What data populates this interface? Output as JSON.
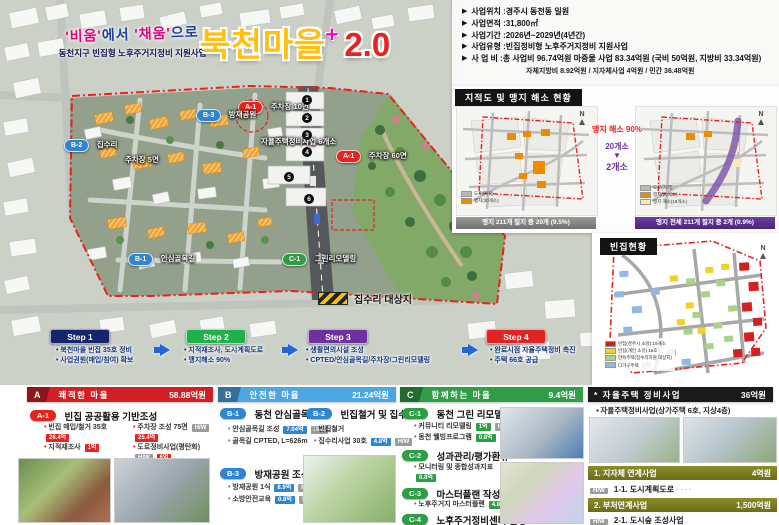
{
  "icons": {
    "info_bullet": "▶",
    "compass": "N"
  },
  "colors": {
    "section_a": "#d21f26",
    "section_b": "#4ba7e2",
    "section_c": "#2f9e46",
    "step1": "#16246e",
    "step2": "#21b14c",
    "step3": "#7030a0",
    "step4": "#e32222",
    "title_yellow": "#ffc10e",
    "title_red": "#e8221f",
    "mangji_orange": "#f08b00",
    "relief_purple": "#6b3fa0"
  },
  "title": {
    "slogan_q1": "'비움'",
    "slogan_m1": "에서 ",
    "slogan_q2": "'채움'",
    "slogan_m2": "으로",
    "subtitle": "동천지구 빈집형 노후주거지정비 지원사업",
    "main": "북천마을",
    "plus": "+",
    "version": "2.0"
  },
  "info": {
    "items": [
      {
        "label": "사업위치",
        "value": "경주시 동천동 일원"
      },
      {
        "label": "사업면적",
        "value": "31,800㎡"
      },
      {
        "label": "사업기간",
        "value": "2026년~2029년(4년간)"
      },
      {
        "label": "사업유형",
        "value": "빈집정비형 노후주거지정비 지원사업"
      },
      {
        "label": "사 업 비",
        "value": "총 사업비 96.74억원 마중물 사업 83.34억원 (국비 50억원, 지방비 33.34억원)"
      }
    ],
    "note": "자체지방비 8.92억원 / 지자체사업 4억원 / 민간 36.48억원"
  },
  "map": {
    "markers": {
      "a1_top": {
        "code": "A-1",
        "label": "주차장 10면"
      },
      "b3": {
        "code": "B-3",
        "label": "방재공원"
      },
      "b2": {
        "code": "B-2",
        "label": "집수리"
      },
      "parking5": "주차장 5면",
      "jayul": "자율주택정비사업 6개소",
      "a1_mid": {
        "code": "A-1",
        "label": "주차장 60면"
      },
      "b1": {
        "code": "B-1",
        "label": "안심골목길"
      },
      "c1": {
        "code": "C-1",
        "label": "그린리모델링"
      }
    },
    "numbers": [
      "1",
      "2",
      "3",
      "4",
      "5",
      "6"
    ],
    "legend": "집수리 대상지"
  },
  "cadastral": {
    "title": "지적도 및 맹지 해소 현황",
    "compass": "N",
    "center": {
      "headline": "맹지 해소 90%",
      "from": "20개소",
      "arrow": "▼",
      "to": "2개소"
    },
    "left_legend": [
      {
        "color": "#b9b9b9",
        "label": "도로(지적)"
      },
      {
        "color": "#f08b00",
        "label": "맹지(20개소)"
      }
    ],
    "right_legend": [
      {
        "color": "#b9b9b9",
        "label": "도로(지적)"
      },
      {
        "color": "#f08b00",
        "label": "맹지(20개소)"
      },
      {
        "color": "#f3ecc2",
        "label": "맹지 해소(18개소)"
      }
    ],
    "left_caption": "맹지 211개 필지 중 20개 (9.5%)",
    "right_caption": "맹지 전체 211개 필지 중 2개 (0.9%)"
  },
  "vacant": {
    "title": "빈집현황",
    "compass": "N",
    "legend": [
      {
        "color": "#cc2020",
        "label": "빈집(경주시 소유) 19개소"
      },
      {
        "color": "#f2d21f",
        "label": "빈집(개인 소유) 16호"
      },
      {
        "color": "#a9d487",
        "label": "단독주택(집수리지원 대상지)"
      },
      {
        "color": "#8fb9e4",
        "label": "다가구주택"
      }
    ]
  },
  "steps": [
    {
      "label": "Step 1",
      "bullets": [
        "북천마을 빈집 35호 정비",
        "사업권원(매입/참여) 확보"
      ]
    },
    {
      "label": "Step 2",
      "bullets": [
        "지적재조사, 도시계획도로",
        "맹지해소 90%"
      ]
    },
    {
      "label": "Step 3",
      "bullets": [
        "생활편의시설 조성",
        "CPTED/안심골목길/주차장/그린리모델링"
      ]
    },
    {
      "label": "Step 4",
      "bullets": [
        "완료시점 자율주택정비 촉진",
        "주택 66호 공급"
      ]
    }
  ],
  "sections": {
    "a": {
      "code": "A",
      "title": "쾌적한 마을",
      "amount": "58.88억원",
      "group": {
        "code": "A-1",
        "title": "빈집 공공활용 기반조성"
      },
      "col1": [
        {
          "text": "빈집 매입/철거 35호",
          "b1": "26.4억"
        },
        {
          "text": "지적재조사",
          "b1": "1억"
        }
      ],
      "col2": [
        {
          "text": "주차장 조성 75면",
          "hw": "H/W",
          "b1": "25.4억"
        },
        {
          "text": "도로정비사업(평탄화)",
          "hw": "H/W",
          "b1": "6억"
        }
      ]
    },
    "b": {
      "code": "B",
      "title": "안전한 마을",
      "amount": "21.24억원",
      "groups": [
        {
          "code": "B-1",
          "title": "동천 안심골목길",
          "bullets": [
            {
              "text": "안심골목길 조성",
              "b1": "7.04억",
              "hw": "H/W"
            },
            {
              "text": "골목길 CPTED, L=626m"
            }
          ]
        },
        {
          "code": "B-2",
          "title": "빈집철거 및 집수리",
          "bullets": [
            {
              "text": "빈집철거"
            },
            {
              "text": "집수리사업 30호",
              "b1": "4.8억",
              "hw": "H/W"
            }
          ]
        },
        {
          "code": "B-3",
          "title": "방재공원 조성",
          "bullets": [
            {
              "text": "방재공원 1식",
              "b1": "8.9억",
              "hw": "H/W"
            },
            {
              "text": "소방안전교육",
              "b1": "0.8억",
              "hw": "S/W"
            }
          ]
        }
      ]
    },
    "c": {
      "code": "C",
      "title": "함께하는 마을",
      "amount": "9.4억원",
      "groups": [
        {
          "code": "C-1",
          "title": "동천 그린 리모델링",
          "bullets": [
            {
              "text": "커뮤니티 리모델링",
              "b1": "1억",
              "hw": "H/W"
            },
            {
              "text": "동천 웰빙프로그램",
              "b1": "0.8억",
              "hw": "S/W"
            }
          ]
        },
        {
          "code": "C-2",
          "title": "성과관리/평가환류",
          "bullets": [
            {
              "text": "모니터링 및 종합성과지표",
              "b1": "0.8억"
            }
          ]
        },
        {
          "code": "C-3",
          "title": "마스터플랜 작성",
          "bullets": [
            {
              "text": "노후주거지 마스터플랜",
              "b1": "4.8억"
            }
          ]
        },
        {
          "code": "C-4",
          "title": "노후주거정비센터 운영",
          "bullets": []
        }
      ]
    }
  },
  "program": {
    "title": "* 자율주택 정비사업",
    "amount": "36억원",
    "bullet": "자율주택정비사업(상가주택 6호, 지상4층)",
    "sub1": {
      "title": "1. 지자체 연계사업",
      "amount": "4억원",
      "tag": "H/W",
      "item": "1-1. 도시계획도로",
      "dots": "∙∙∙∙"
    },
    "sub2": {
      "title": "2. 부처연계사업",
      "amount": "1,500억원",
      "tag": "H/W",
      "item": "2-1. 도시숲 조성사업"
    }
  }
}
